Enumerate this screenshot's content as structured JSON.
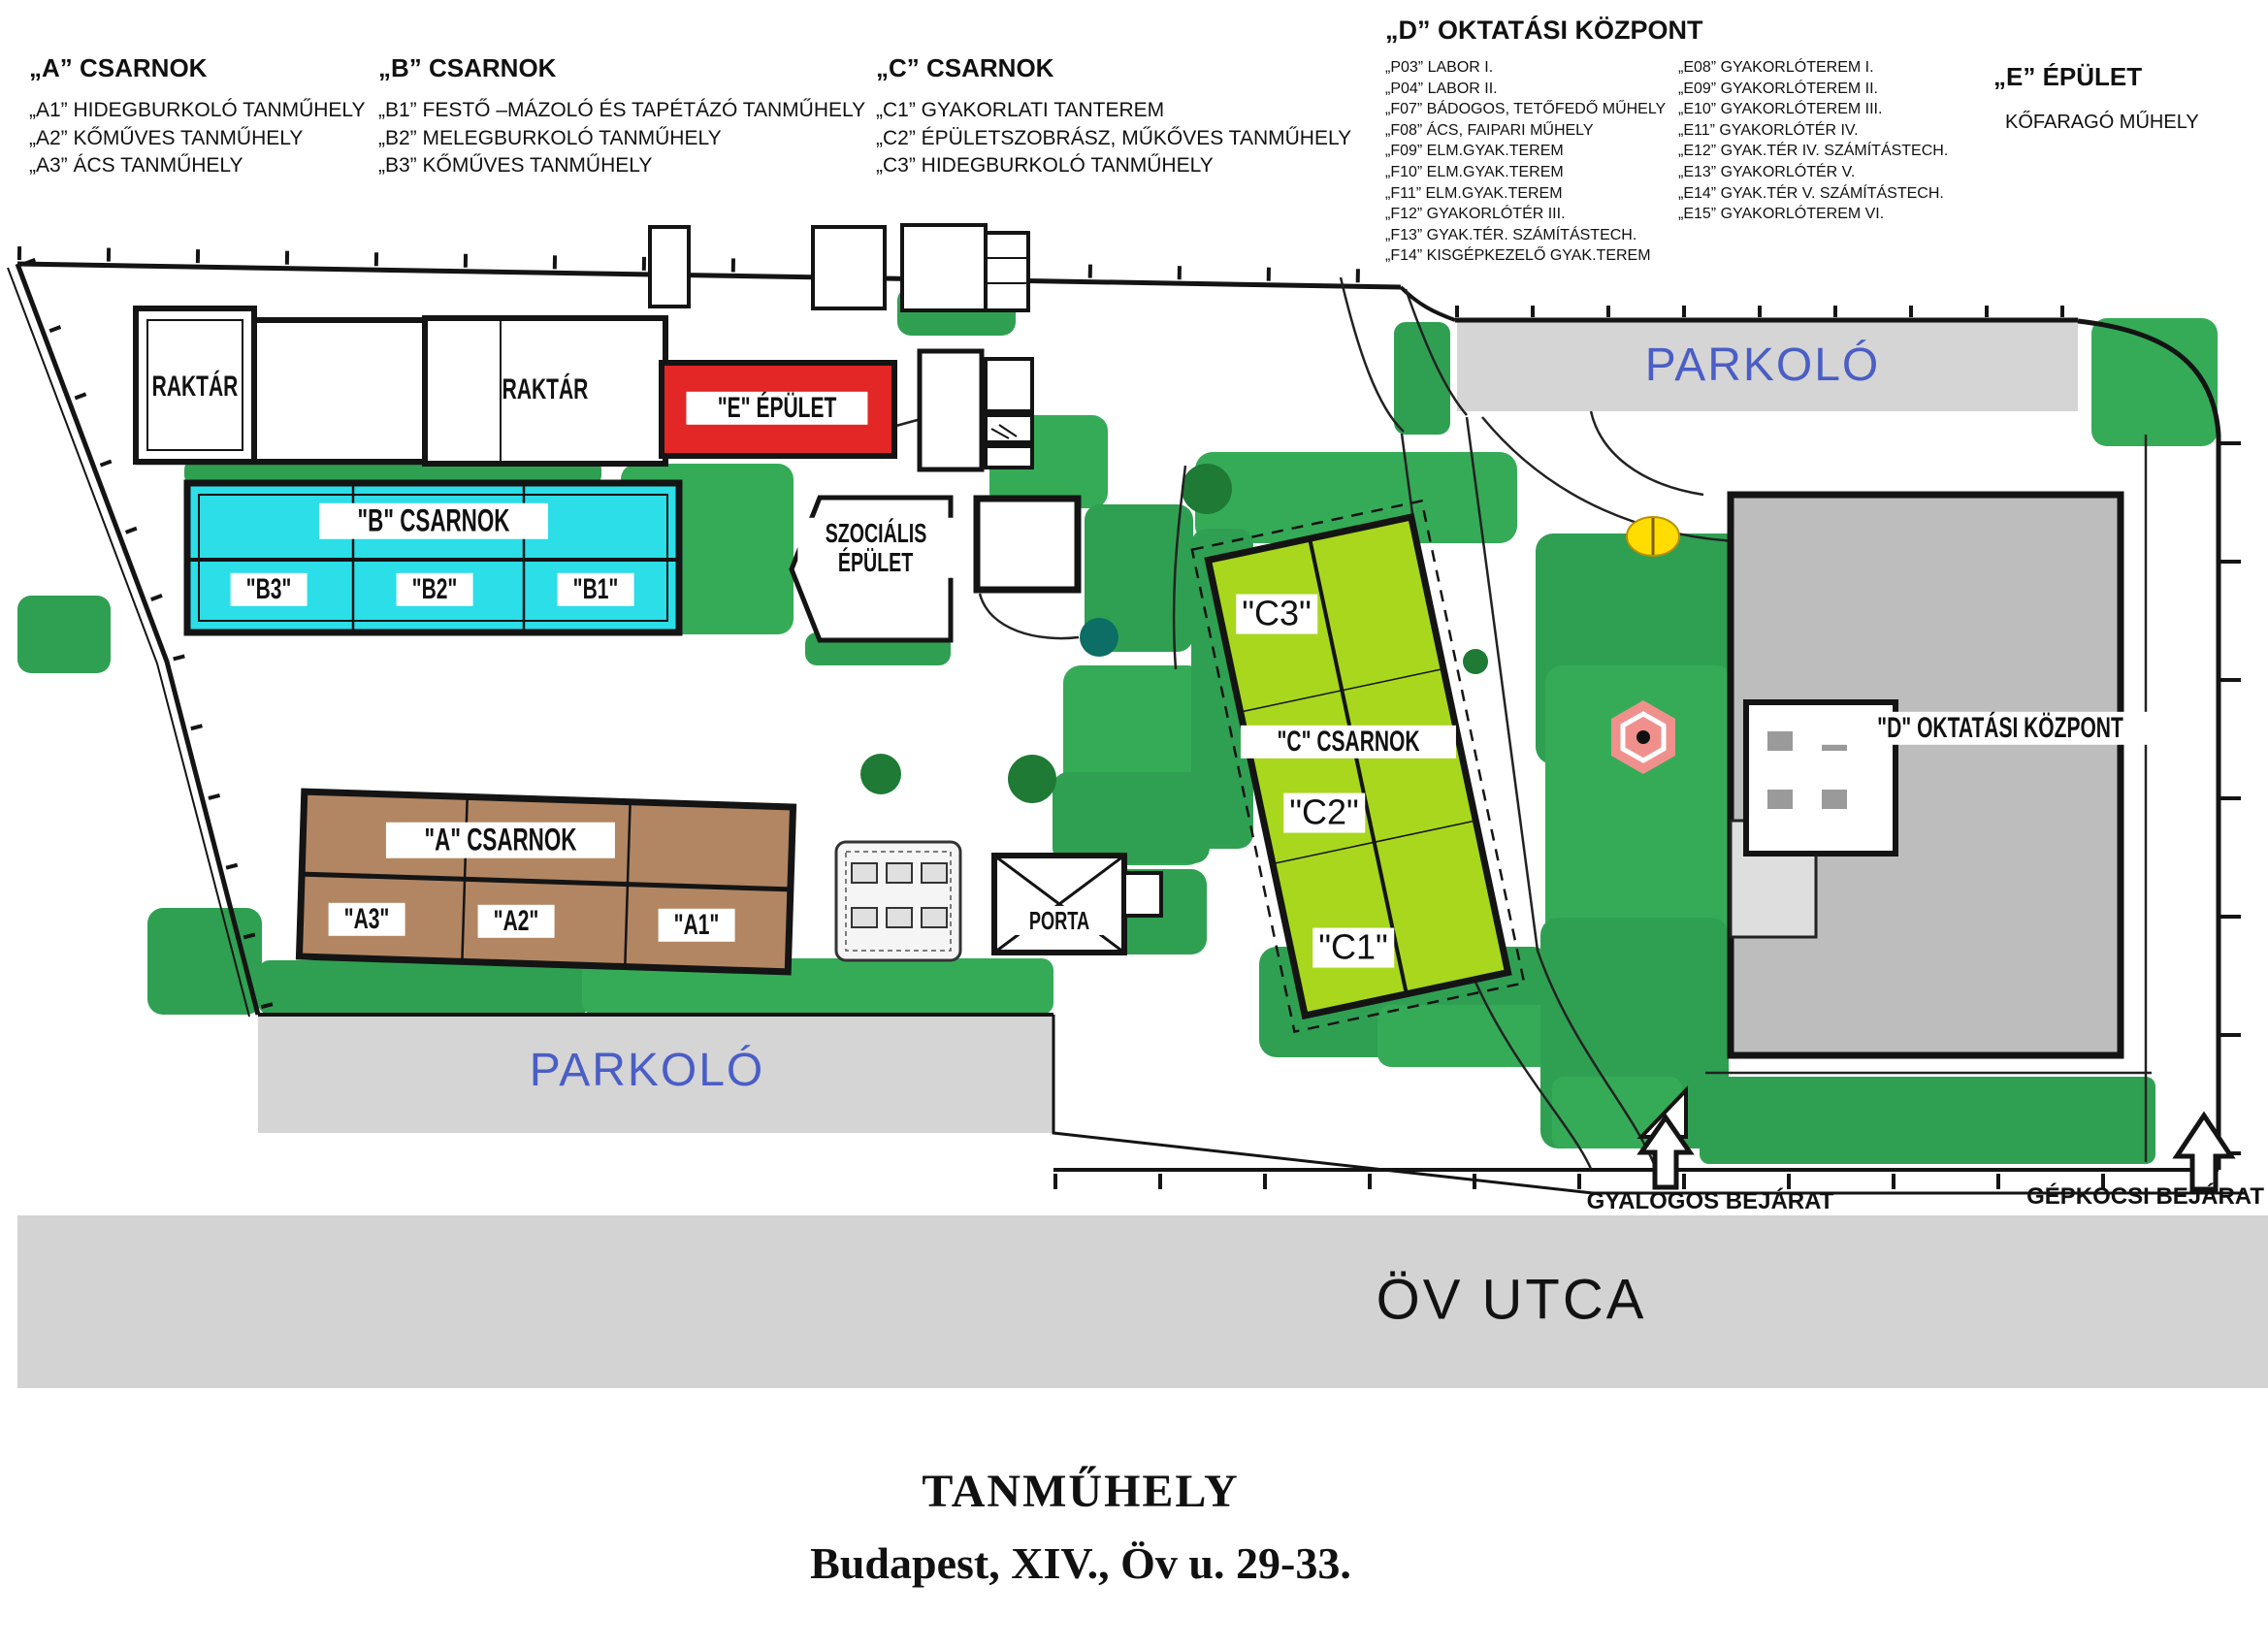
{
  "legend": {
    "a": {
      "title": "„A” CSARNOK",
      "items": [
        "„A1” HIDEGBURKOLÓ TANMŰHELY",
        "„A2” KŐMŰVES TANMŰHELY",
        "„A3” ÁCS TANMŰHELY"
      ]
    },
    "b": {
      "title": "„B” CSARNOK",
      "items": [
        "„B1” FESTŐ –MÁZOLÓ ÉS TAPÉTÁZÓ TANMŰHELY",
        "„B2” MELEGBURKOLÓ TANMŰHELY",
        "„B3” KŐMŰVES TANMŰHELY"
      ]
    },
    "c": {
      "title": "„C” CSARNOK",
      "items": [
        "„C1” GYAKORLATI TANTEREM",
        "„C2” ÉPÜLETSZOBRÁSZ, MŰKŐVES TANMŰHELY",
        "„C3” HIDEGBURKOLÓ TANMŰHELY"
      ]
    },
    "d": {
      "title": "„D” OKTATÁSI KÖZPONT",
      "col1": [
        "„P03” LABOR I.",
        "„P04” LABOR II.",
        "„F07” BÁDOGOS, TETŐFEDŐ MŰHELY",
        "„F08” ÁCS, FAIPARI MŰHELY",
        "„F09” ELM.GYAK.TEREM",
        "„F10” ELM.GYAK.TEREM",
        "„F11” ELM.GYAK.TEREM",
        "„F12” GYAKORLÓTÉR III.",
        "„F13” GYAK.TÉR. SZÁMÍTÁSTECH.",
        "„F14” KISGÉPKEZELŐ GYAK.TEREM"
      ],
      "col2": [
        "„E08” GYAKORLÓTEREM I.",
        "„E09” GYAKORLÓTEREM II.",
        "„E10” GYAKORLÓTEREM III.",
        "„E11” GYAKORLÓTÉR IV.",
        "„E12” GYAK.TÉR IV. SZÁMÍTÁSTECH.",
        "„E13” GYAKORLÓTÉR V.",
        "„E14” GYAK.TÉR V. SZÁMÍTÁSTECH.",
        "„E15” GYAKORLÓTEREM VI."
      ]
    },
    "e": {
      "title": "„E” ÉPÜLET",
      "item": "KŐFARAGÓ MŰHELY"
    }
  },
  "map": {
    "labels": {
      "raktar_left": "RAKTÁR",
      "raktar_right": "RAKTÁR",
      "e_building": "\"E\" ÉPÜLET",
      "b_hall": "\"B\" CSARNOK",
      "b3": "\"B3\"",
      "b2": "\"B2\"",
      "b1": "\"B1\"",
      "szocialis_1": "SZOCIÁLIS",
      "szocialis_2": "ÉPÜLET",
      "a_hall": "\"A\" CSARNOK",
      "a3": "\"A3\"",
      "a2": "\"A2\"",
      "a1": "\"A1\"",
      "porta": "PORTA",
      "c_hall": "\"C\" CSARNOK",
      "c3": "\"C3\"",
      "c2": "\"C2\"",
      "c1": "\"C1\"",
      "d_center": "\"D\" OKTATÁSI KÖZPONT"
    },
    "parking_top": "PARKOLÓ",
    "parking_left": "PARKOLÓ",
    "entrances": {
      "pedestrian": "GYALOGOS BEJÁRAT",
      "vehicle": "GÉPKOCSI BEJÁRAT"
    },
    "street": "ÖV UTCA"
  },
  "footer": {
    "title": "TANMŰHELY",
    "address": "Budapest, XIV., Öv u. 29-33."
  },
  "colors": {
    "green": "#2FA052",
    "green2": "#35AB57",
    "tree": "#1E7A35",
    "teal": "#0C6E64",
    "cyan": "#2BDEE8",
    "brown": "#B28663",
    "lime": "#A8D71E",
    "red": "#E32726",
    "gray_building": "#BDBDBD",
    "gray_parking": "#D5D5D5",
    "gray_street": "#D3D3D3",
    "blue_text": "#4A5EC6",
    "pink": "#F0908C",
    "yellow": "#FFDD00",
    "ink": "#141414"
  }
}
